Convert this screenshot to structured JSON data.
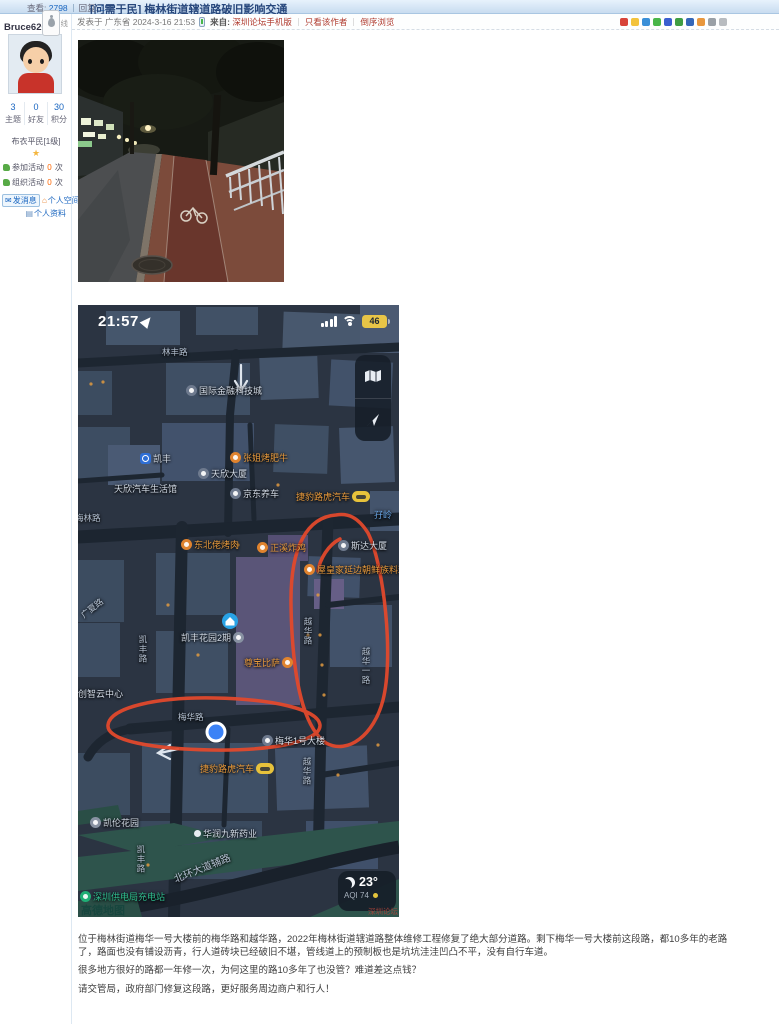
{
  "header": {
    "views_label": "查看:",
    "views": "2798",
    "replies_label": "回复:",
    "replies": "1",
    "title": "[问需于民] 梅林街道辖道路破旧影响交通"
  },
  "meta": {
    "posted": "发表于 广东省 2024-3-16 21:53",
    "from_label": "来自:",
    "from_link": "深圳论坛手机版",
    "only_author": "只看该作者",
    "order": "倒序浏览",
    "share_icons": [
      {
        "name": "share-weibo-icon",
        "color": "#d8443a"
      },
      {
        "name": "share-qzone-icon",
        "color": "#f3c33c"
      },
      {
        "name": "share-qq-icon",
        "color": "#3a8fd8"
      },
      {
        "name": "share-wechat-icon",
        "color": "#49b649"
      },
      {
        "name": "share-tieba-icon",
        "color": "#3a5fd0"
      },
      {
        "name": "share-douban-icon",
        "color": "#3f9e43"
      },
      {
        "name": "share-renren-icon",
        "color": "#3567b8"
      },
      {
        "name": "share-taobao-icon",
        "color": "#e8973d"
      },
      {
        "name": "share-copylink-icon",
        "color": "#9aa0a6"
      },
      {
        "name": "share-more-icon",
        "color": "#b8bcc0"
      }
    ]
  },
  "sidebar": {
    "username": "Bruce626",
    "status": "离线",
    "stats": [
      {
        "value": "3",
        "label": "主题"
      },
      {
        "value": "0",
        "label": "好友"
      },
      {
        "value": "30",
        "label": "积分"
      }
    ],
    "rank": "布衣平民[1级]",
    "star": "★",
    "activities": [
      {
        "prefix": "参加活动",
        "count": "0",
        "suffix": "次"
      },
      {
        "prefix": "组织活动",
        "count": "0",
        "suffix": "次"
      }
    ],
    "send_message": "发消息",
    "space": "个人空间",
    "profile": "个人资料"
  },
  "post": {
    "paragraphs": [
      "位于梅林街道梅华一号大楼前的梅华路和越华路，2022年梅林街道辖道路整体维修工程修复了绝大部分道路。剩下梅华一号大楼前这段路，都10多年的老路了，路面也没有铺设沥青，行人道砖块已经破旧不堪，管线道上的预制板也是坑坑洼洼凹凸不平，没有自行车道。",
      "很多地方很好的路都一年修一次，为何这里的路10多年了也没管？难道差这点钱？",
      "请交管局，政府部门修复这段路，更好服务周边商户和行人！"
    ]
  },
  "map": {
    "time": "21:57",
    "battery": "46",
    "temp": "23°",
    "aqi": "AQI 74",
    "amap_watermark": "高德地图",
    "forum_watermark": "深圳论坛",
    "pois": [
      {
        "text": "林丰路",
        "x": 84,
        "y": 41,
        "type": "road"
      },
      {
        "text": "国际金融科技城",
        "x": 108,
        "y": 79,
        "type": "white",
        "icon": "building"
      },
      {
        "text": "凯丰",
        "x": 62,
        "y": 147,
        "type": "white",
        "icon": "metro"
      },
      {
        "text": "张姐烤肥牛",
        "x": 152,
        "y": 146,
        "type": "orange",
        "icon": "restaurant"
      },
      {
        "text": "天欣大厦",
        "x": 120,
        "y": 162,
        "type": "white",
        "icon": "building"
      },
      {
        "text": "天欣汽车生活馆",
        "x": 36,
        "y": 177,
        "type": "white"
      },
      {
        "text": "京东养车",
        "x": 152,
        "y": 182,
        "type": "white",
        "icon": "building"
      },
      {
        "text": "捷豹路虎汽车",
        "x": 218,
        "y": 185,
        "type": "orange",
        "icon_after": "car"
      },
      {
        "text": "梅林路",
        "x": -3,
        "y": 207,
        "type": "road"
      },
      {
        "text": "孖岭",
        "x": 296,
        "y": 203,
        "type": "blue"
      },
      {
        "text": "东北佬烤肉",
        "x": 103,
        "y": 233,
        "type": "orange",
        "icon": "restaurant"
      },
      {
        "text": "正溪炸鸡",
        "x": 179,
        "y": 236,
        "type": "orange",
        "icon": "restaurant"
      },
      {
        "text": "斯达大厦",
        "x": 260,
        "y": 234,
        "type": "white",
        "icon": "building"
      },
      {
        "text": "屋皇家延边朝鲜族料理",
        "x": 226,
        "y": 258,
        "type": "orange",
        "icon": "restaurant"
      },
      {
        "text": "广夏路",
        "x": 4,
        "y": 305,
        "type": "road",
        "rot": -38
      },
      {
        "text": "凯丰花园2期",
        "x": 103,
        "y": 326,
        "type": "white",
        "icon_after": "home"
      },
      {
        "text": "凯丰路",
        "x": 59,
        "y": 330,
        "type": "roadv"
      },
      {
        "text": "尊宝比萨",
        "x": 166,
        "y": 351,
        "type": "orange",
        "icon_after": "pizza"
      },
      {
        "text": "越华路",
        "x": 224,
        "y": 312,
        "type": "roadv"
      },
      {
        "text": "越华一路",
        "x": 282,
        "y": 342,
        "type": "roadv"
      },
      {
        "text": "创智云中心",
        "x": 0,
        "y": 382,
        "type": "white"
      },
      {
        "text": "梅华路",
        "x": 100,
        "y": 406,
        "type": "road"
      },
      {
        "text": "梅华1号大楼",
        "x": 184,
        "y": 429,
        "type": "white",
        "icon": "building"
      },
      {
        "text": "捷豹路虎汽车",
        "x": 122,
        "y": 457,
        "type": "orange",
        "icon_after": "car"
      },
      {
        "text": "越华路",
        "x": 223,
        "y": 452,
        "type": "roadv"
      },
      {
        "text": "凯伦花园",
        "x": 12,
        "y": 511,
        "type": "white",
        "icon": "home"
      },
      {
        "text": "华润九新药业",
        "x": 116,
        "y": 522,
        "type": "white",
        "icon": "dot"
      },
      {
        "text": "凯丰路",
        "x": 57,
        "y": 540,
        "type": "roadv"
      },
      {
        "text": "深圳供电局充电站",
        "x": 2,
        "y": 585,
        "type": "green",
        "icon": "charge"
      },
      {
        "text": "北环大道辅路",
        "x": 96,
        "y": 566,
        "type": "road big",
        "rot": -22
      }
    ]
  }
}
